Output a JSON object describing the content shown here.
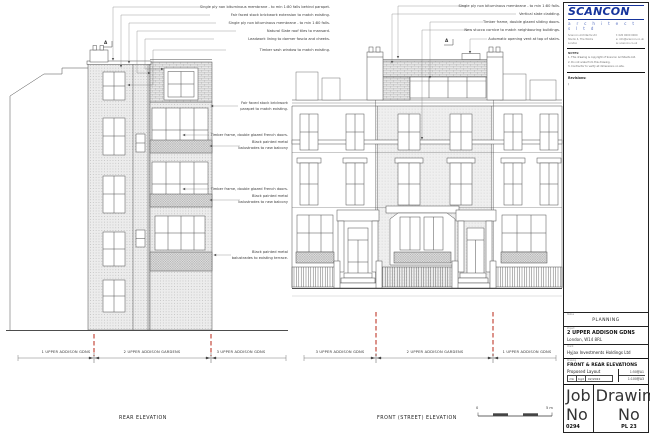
{
  "sheet": {
    "logo_name": "SCANCON",
    "logo_sub": "a r c h i t e c t s   l t d",
    "contact_left": [
      "Scancon Architects Ltd",
      "Studio 4, The Works",
      "London"
    ],
    "contact_right": [
      "t: 020 0000 0000",
      "e: info@scancon.co.uk",
      "w: scancon.co.uk"
    ],
    "notes_label": "NOTES:",
    "notes": [
      "1. This drawing is copyright of Scancon Architects Ltd.",
      "2. Do not scale from this drawing.",
      "3. Contractor to verify all dimensions on site."
    ],
    "revisions_label": "Revisions:",
    "revisions_value": "/",
    "status_label": "Status",
    "status": "PLANNING",
    "project_label": "Project",
    "project": "2 UPPER ADDISON GDNS",
    "project_sub": "London, W14 8RL",
    "client_label": "Client",
    "client": "Hyjax Investments Holdings Ltd",
    "drawing_label": "Drawing",
    "drawing": "FRONT & REAR ELEVATIONS",
    "drawing_sub": "Proposed Layout",
    "scale1": "1:50@A1",
    "scale2": "1:100@A3",
    "drawn": "mk",
    "checked": "bgd",
    "date": "02/2022",
    "job_label": "Job No",
    "job_no": "0294",
    "dwg_label": "Drawing No",
    "dwg_no": "PL 23",
    "rev_label": "Rev",
    "rev": "/"
  },
  "annotations": {
    "rear_top": [
      "Single ply non bituminous membrane - to min 1:80 falls behind parapet.",
      "Fair faced stock brickwork extension to match existing.",
      "Single ply non bituminous membrane - to min 1:80 falls.",
      "Natural Slate roof tiles to mansard.",
      "Leadwork lining to dormer fascia and cheeks.",
      "Timber sash window to match existing."
    ],
    "front_top": [
      "Single ply non bituminous membrane - to min 1:80 falls.",
      "Vertical slate cladding.",
      "Timber frame, double glazed sliding doors.",
      "New stucco cornice to match neighbouring buildings.",
      "Automatic opening vent at top of stairs."
    ],
    "rear_mid": [
      "Fair faced stock brickwork\nparapet to match existing.",
      "Timber frame, double glazed French doors.",
      "Black painted metal\nbalustrades to new balcony",
      "Timber frame, double glazed French doors.",
      "Black painted metal\nbalustrades to new balcony",
      "Black painted metal\nbalustrades to existing terrace."
    ]
  },
  "labels": {
    "rear_title": "REAR ELEVATION",
    "front_title": "FRONT (STREET) ELEVATION",
    "left_houses": [
      "1 UPPER ADDISON GDNS",
      "2 UPPER ADDISON GARDENS",
      "3 UPPER ADDISON GDNS"
    ],
    "right_houses": [
      "3 UPPER ADDISON GDNS",
      "2 UPPER ADDISON GARDENS",
      "1 UPPER ADDISON GDNS"
    ],
    "scalebar_zero": "0",
    "scalebar_max": "5 m",
    "section_marker": "A"
  },
  "colors": {
    "accent_blue": "#16349c",
    "datum_red": "#c0392b",
    "linework": "#4d4d4d"
  }
}
